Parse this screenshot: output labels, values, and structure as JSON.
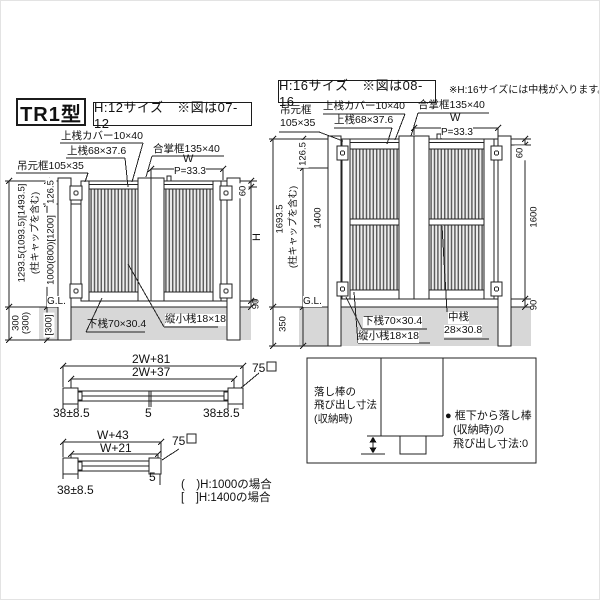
{
  "left": {
    "model": "TR1型",
    "size": "H:12サイズ　※図は07-12",
    "labels": {
      "top_cover": "上桟カバー10×40",
      "top_rail": "上桟68×37.6",
      "hinge_stile": "吊元框105×35",
      "meeting_stile": "合掌框135×40",
      "width": "W",
      "pitch": "P=33.3",
      "ground": "G.L.",
      "bottom_rail": "下桟70×30.4",
      "vertical_rail": "縦小桟18×18"
    },
    "dims": {
      "total": "1293.5(1093.5)[1493.5]",
      "cap": "(柱キャップを含む)",
      "gate": "1000(800)[1200]",
      "offset": "126.5",
      "below_a": "300",
      "below_b": "(300)",
      "below_c": "[300]",
      "top_gap": "60",
      "height": "H",
      "bottom_gap": "90"
    }
  },
  "right": {
    "size": "H:16サイズ　※図は08-16",
    "note": "※H:16サイズには中桟が入ります。",
    "labels": {
      "hinge_stile_1": "吊元框",
      "hinge_stile_2": "105×35",
      "top_cover": "上桟カバー10×40",
      "top_rail": "上桟68×37.6",
      "meeting_stile": "合掌框135×40",
      "width": "W",
      "pitch": "P=33.3",
      "ground": "G.L.",
      "bottom_rail": "下桟70×30.4",
      "vertical_rail": "縦小桟18×18",
      "mid_rail_1": "中桟",
      "mid_rail_2": "28×30.8"
    },
    "dims": {
      "total": "1693.5",
      "cap": "(柱キャップを含む)",
      "gate": "1400",
      "offset": "126.5",
      "below": "350",
      "top_gap": "60",
      "height": "1600",
      "bottom_gap": "90"
    }
  },
  "sections": {
    "double": {
      "overall": "2W+81",
      "inner": "2W+37",
      "post": "75",
      "gap_left": "38±8.5",
      "gap_center": "5",
      "gap_right": "38±8.5"
    },
    "single": {
      "overall": "W+43",
      "inner": "W+21",
      "post": "75",
      "gap": "38±8.5",
      "edge": "5"
    },
    "legend_h1000": "(　)H:1000の場合",
    "legend_h1400": "[　]H:1400の場合"
  },
  "notebox": {
    "caption_1": "落し棒の",
    "caption_2": "飛び出し寸法",
    "caption_3": "(収納時)",
    "note_1": "● 框下から落し棒",
    "note_2": "(収納時)の",
    "note_3": "飛び出し寸法:0"
  }
}
